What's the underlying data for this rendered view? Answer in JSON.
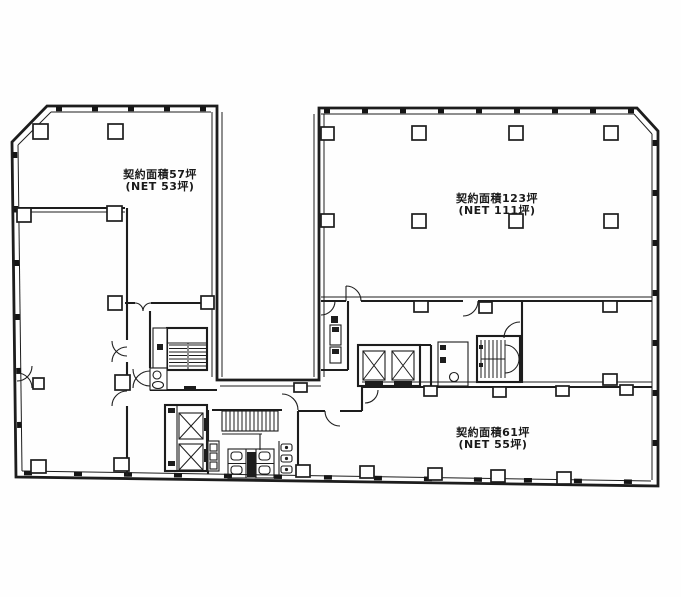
{
  "page": {
    "background_color": "#ffffff",
    "line_color": "#1d1d1d",
    "drawing_type": "building-floor-plan"
  },
  "floor_plan": {
    "units": [
      {
        "id": "unit-northwest",
        "label_line1": "契約面積57坪",
        "label_line2": "(NET 53坪)",
        "contract_area_tsubo": "57",
        "net_area_tsubo": "53"
      },
      {
        "id": "unit-northeast",
        "label_line1": "契約面積123坪",
        "label_line2": "(NET 111坪)",
        "contract_area_tsubo": "123",
        "net_area_tsubo": "111"
      },
      {
        "id": "unit-southeast",
        "label_line1": "契約面積61坪",
        "label_line2": "(NET 55坪)",
        "contract_area_tsubo": "61",
        "net_area_tsubo": "55"
      }
    ],
    "core_features": [
      "elevator-bank-east",
      "elevator-bank-west",
      "staircase-west",
      "staircase-east",
      "escalator",
      "restroom-west",
      "restroom-south",
      "service-shaft",
      "utility-room",
      "courtyard"
    ]
  }
}
